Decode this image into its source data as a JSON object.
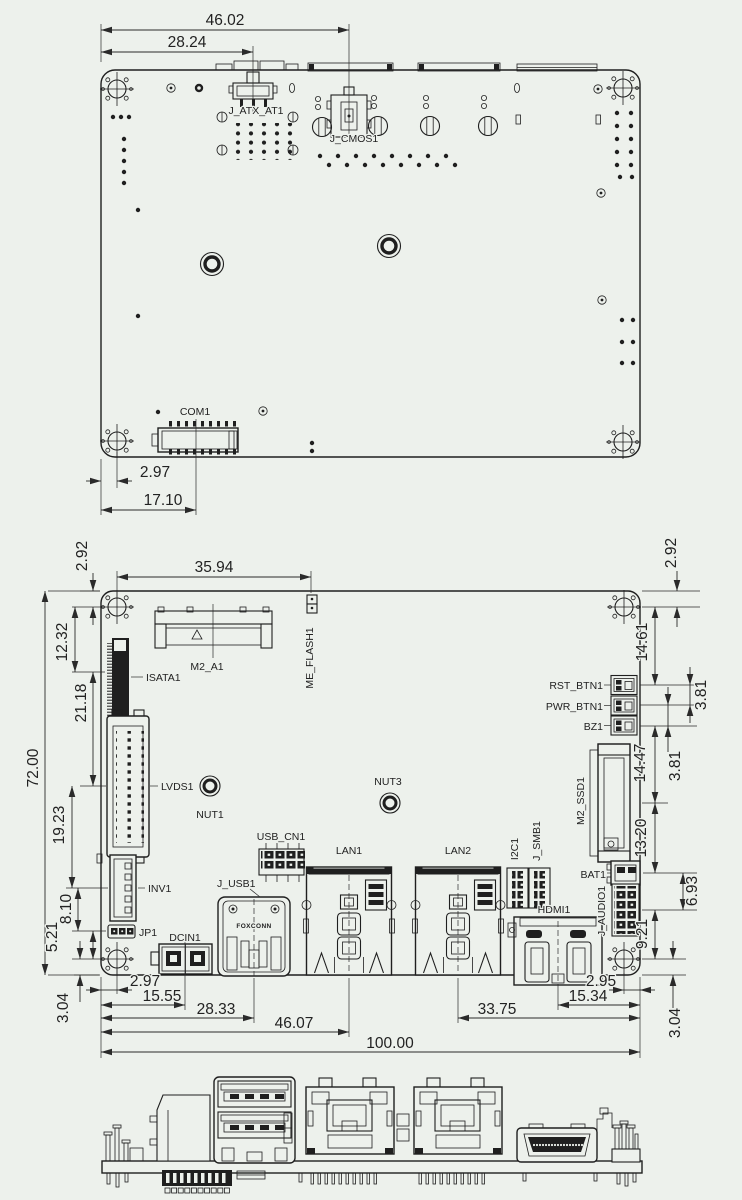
{
  "colors": {
    "background": "#edf1ec",
    "line": "#1f1f1f",
    "text": "#222222"
  },
  "top_view": {
    "dims": {
      "width_46": "46.02",
      "width_28": "28.24",
      "offset_297": "2.97",
      "com_offset": "17.10"
    },
    "labels": {
      "atx": "J_ATX_AT1",
      "cmos": "J_CMOS1",
      "com": "COM1"
    }
  },
  "board_view": {
    "dims": {
      "top": {
        "left_292": "2.92",
        "width_3594": "35.94",
        "right_292": "2.92"
      },
      "left": {
        "d1232": "12.32",
        "d2118": "21.18",
        "d7200": "72.00",
        "d1923": "19.23",
        "d810": "8.10",
        "d521": "5.21",
        "d304": "3.04"
      },
      "right": {
        "d1461": "14.61",
        "d381a": "3.81",
        "d381b": "3.81",
        "d1447": "14.47",
        "d1320": "13.20",
        "d693": "6.93",
        "d921": "9.21",
        "d304": "3.04"
      },
      "bottom": {
        "d297": "2.97",
        "d1555": "15.55",
        "d2833": "28.33",
        "d4607": "46.07",
        "d10000": "100.00",
        "d3375": "33.75",
        "d1534": "15.34",
        "d295": "2.95"
      }
    },
    "labels": {
      "isata": "ISATA1",
      "m2_a": "M2_A1",
      "me_flash": "ME_FLASH1",
      "rst_btn": "RST_BTN1",
      "pwr_btn": "PWR_BTN1",
      "bz": "BZ1",
      "lvds": "LVDS1",
      "nut1": "NUT1",
      "nut3": "NUT3",
      "m2_ssd": "M2_SSD1",
      "usb_cn": "USB_CN1",
      "j_usb": "J_USB1",
      "lan1": "LAN1",
      "lan2": "LAN2",
      "i2c": "I2C1",
      "j_smb": "J_SMB1",
      "bat": "BAT1",
      "inv": "INV1",
      "jp": "JP1",
      "dcin": "DCIN1",
      "hdmi": "HDMI1",
      "j_audio": "J_AUDIO1",
      "usb_brand": "FOXCONN"
    }
  }
}
